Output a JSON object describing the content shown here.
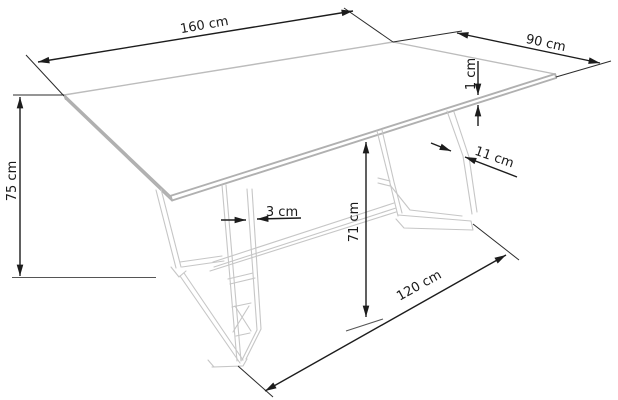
{
  "diagram": {
    "subject": "dining-table-dimension-drawing",
    "unit": "cm",
    "background_color": "#ffffff",
    "dimension_line_color": "#1c1c1c",
    "furniture_line_color": "#c6c6c6",
    "label_color": "#1a1a1a",
    "dimensions": {
      "table_length": {
        "label": "160 cm",
        "value": 160,
        "measures": "tabletop length (far long edge)"
      },
      "table_depth": {
        "label": "90 cm",
        "value": 90,
        "measures": "tabletop depth (right short edge)"
      },
      "top_thickness": {
        "label": "1 cm",
        "value": 1,
        "measures": "tabletop slab thickness"
      },
      "table_height": {
        "label": "75 cm",
        "value": 75,
        "measures": "overall height, floor to top surface"
      },
      "leg_profile_width": {
        "label": "11 cm",
        "value": 11,
        "measures": "leg strut profile width"
      },
      "frame_tube_width": {
        "label": "3 cm",
        "value": 3,
        "measures": "leg frame tube width"
      },
      "underside_clearance": {
        "label": "71 cm",
        "value": 71,
        "measures": "floor to tabletop underside"
      },
      "base_span": {
        "label": "120 cm",
        "value": 120,
        "measures": "distance between leg feet on floor"
      }
    }
  }
}
